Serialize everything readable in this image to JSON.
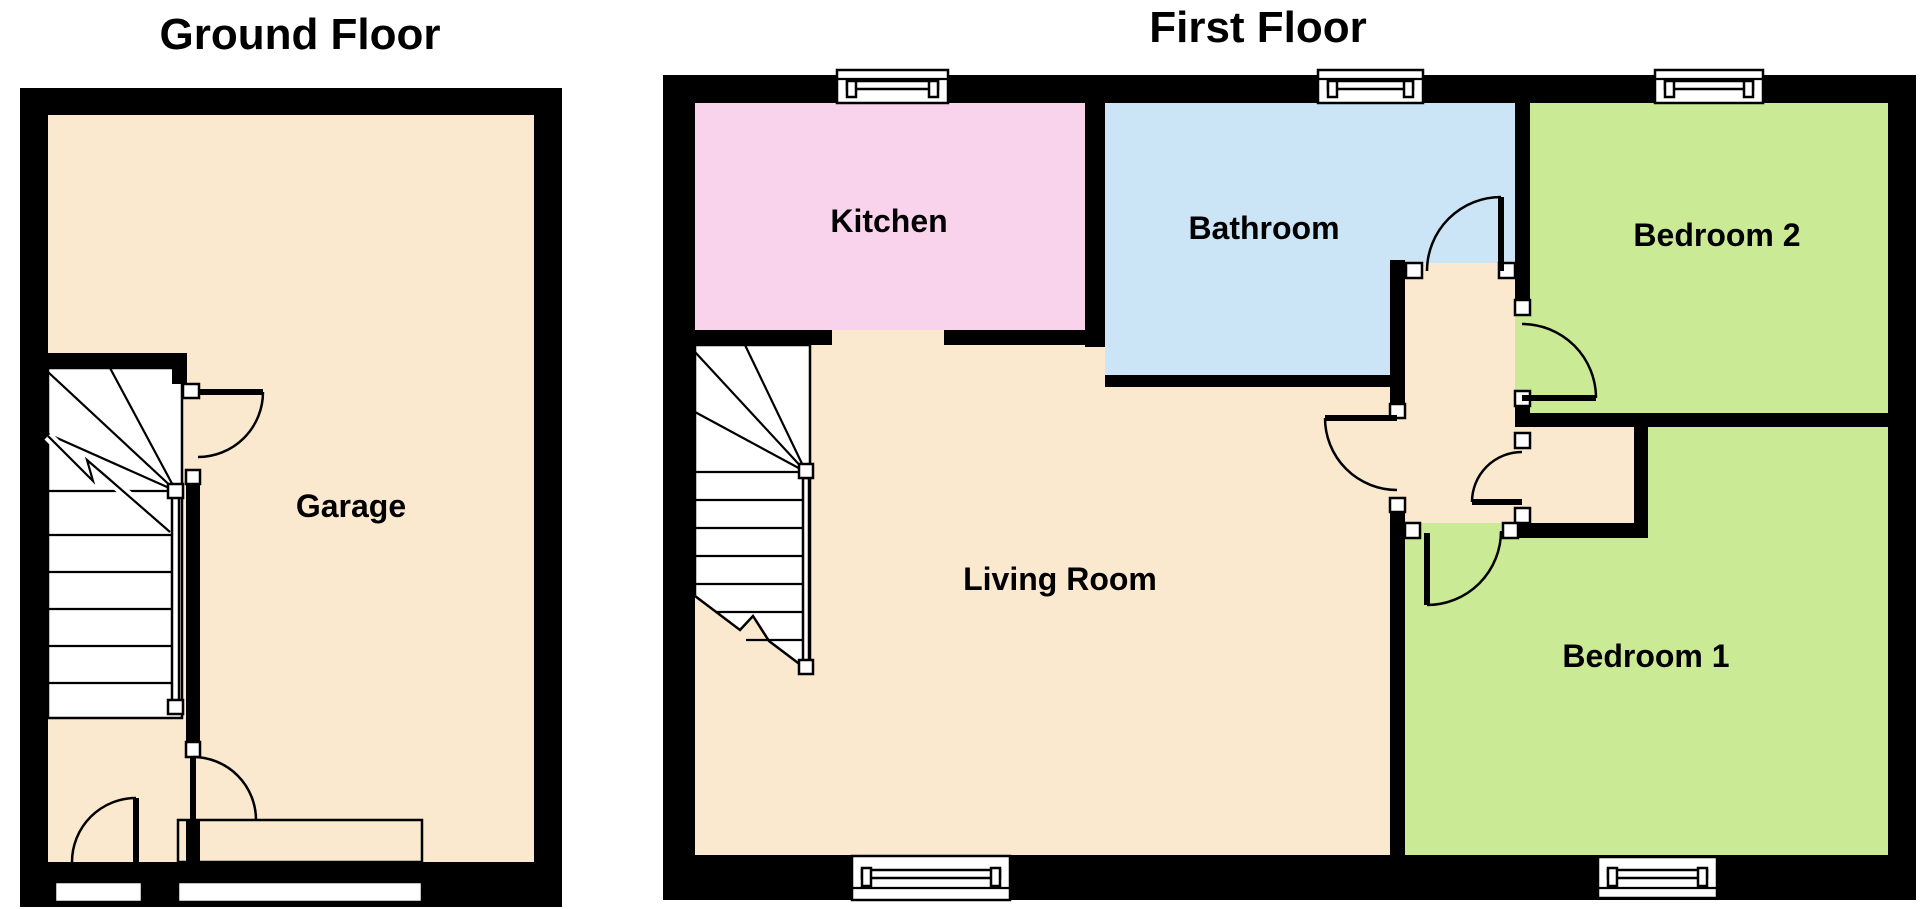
{
  "colors": {
    "background": "#ffffff",
    "wall": "#000000",
    "floor": "#fae9ce",
    "kitchen": "#f9d3ec",
    "bathroom": "#cbe4f6",
    "bedroom": "#cbea96",
    "window": "#ffffff",
    "text": "#000000"
  },
  "ground_floor": {
    "title": "Ground Floor",
    "rooms": {
      "garage": {
        "label": "Garage"
      }
    }
  },
  "first_floor": {
    "title": "First Floor",
    "rooms": {
      "kitchen": {
        "label": "Kitchen"
      },
      "bathroom": {
        "label": "Bathroom"
      },
      "bedroom2": {
        "label": "Bedroom 2"
      },
      "living_room": {
        "label": "Living Room"
      },
      "bedroom1": {
        "label": "Bedroom 1"
      }
    }
  }
}
